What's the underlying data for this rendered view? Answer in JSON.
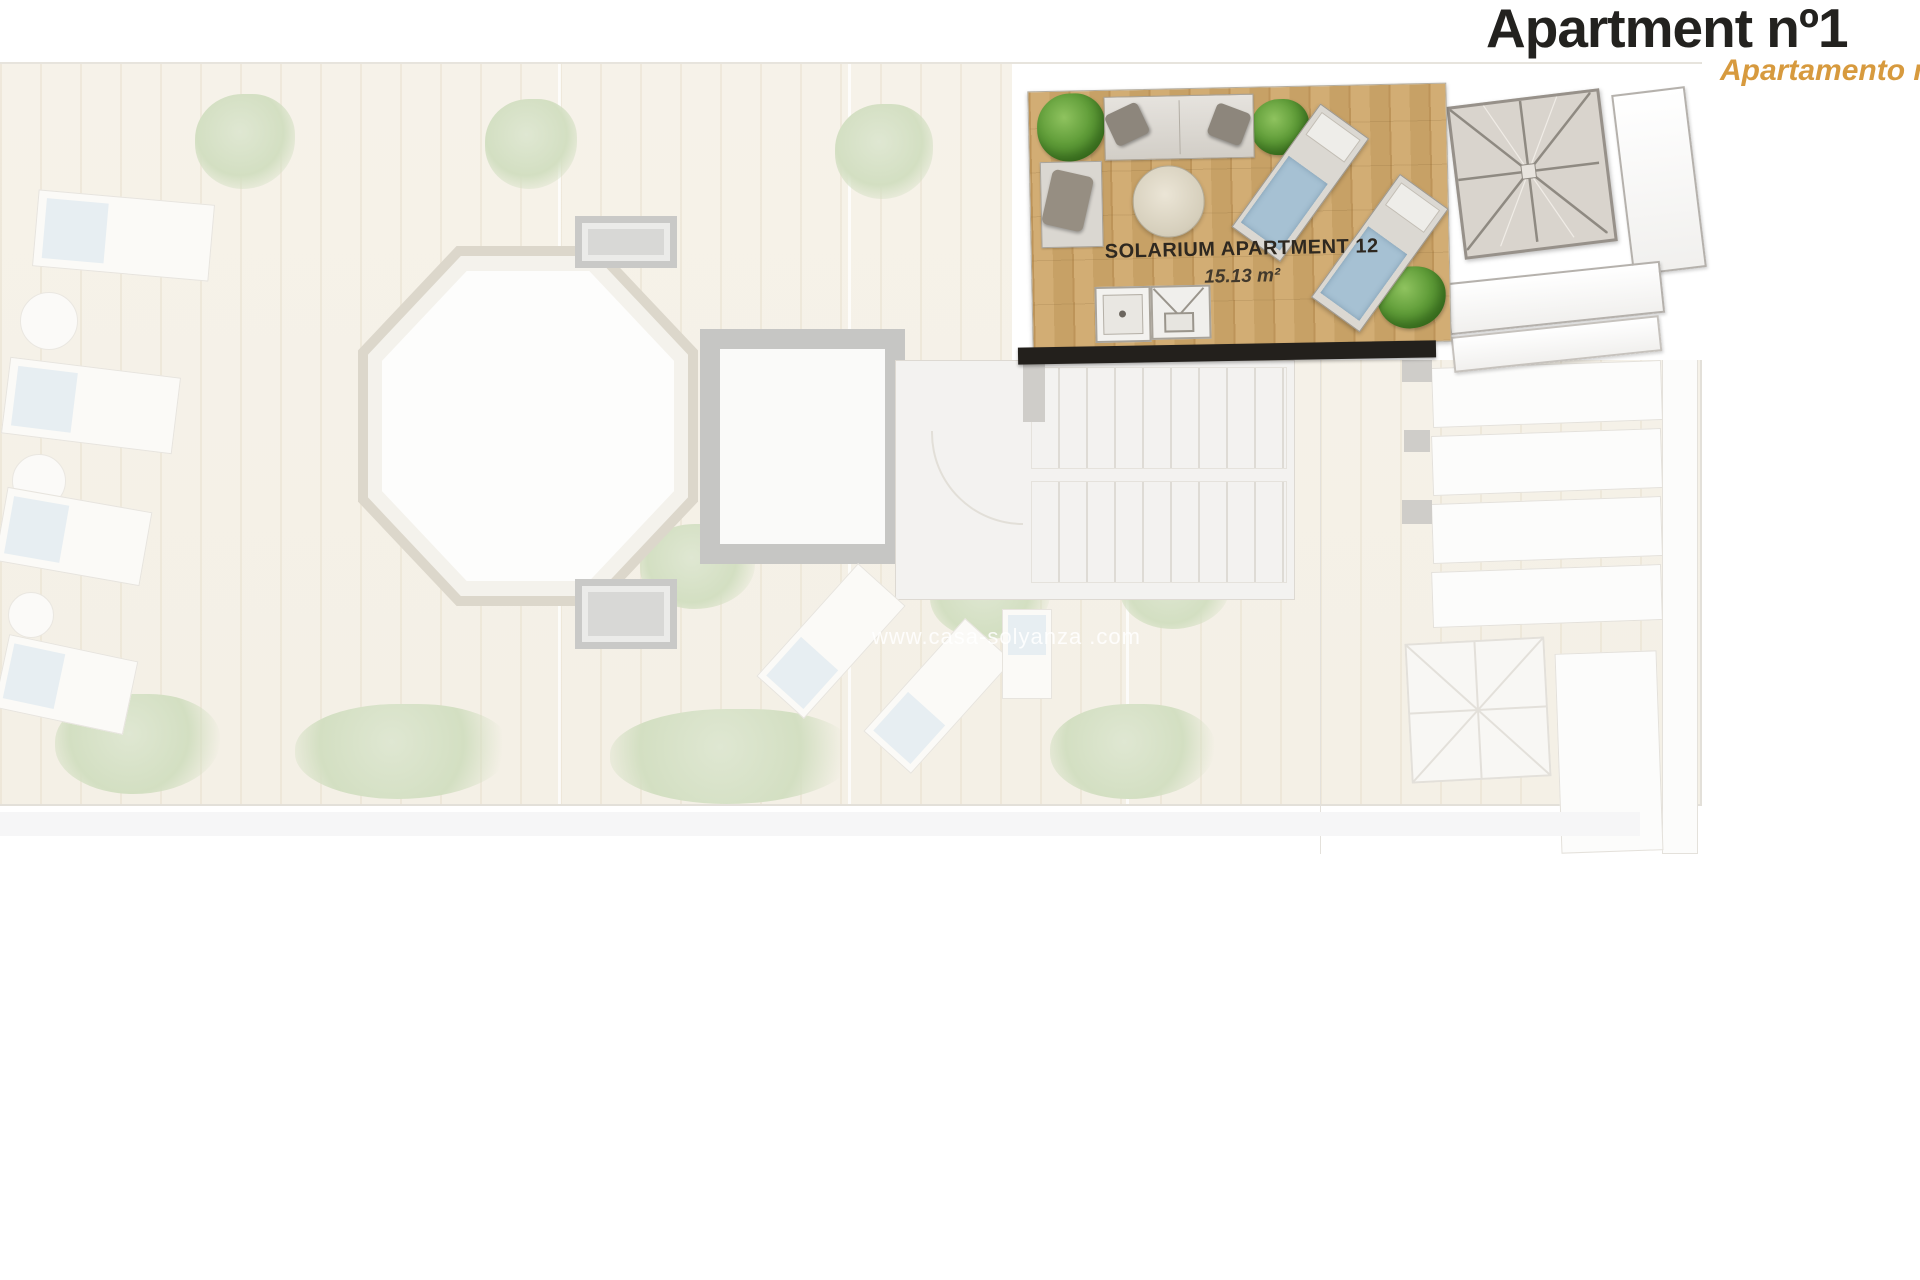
{
  "header": {
    "title": "Apartment nº1",
    "subtitle": "Apartamento nº",
    "title_color": "#23221f",
    "subtitle_color": "#d79a3e"
  },
  "solarium": {
    "label": "SOLARIUM APARTMENT 12",
    "area": "15.13 m²",
    "deck_color": "#cba76c",
    "wall_color": "#23201c",
    "towel_color": "#a6c1d3",
    "plant_color": "#5f9c38"
  },
  "plan": {
    "watermark": "www.casa-solyanza .com",
    "background_color": "#f5f1e8",
    "pool_shape": "octagon"
  },
  "icons": {
    "plant-icon": "green radial blob",
    "sofa-icon": "light rect with two dark pillows",
    "armchair-icon": "rect with rotated cushion",
    "round-table-icon": "beige circle",
    "sun-lounger-icon": "rect with blue towel",
    "shower-tray-icon": "square with drain dot",
    "storage-box-icon": "square with V fold lines",
    "hip-roof-icon": "square with radiating ridge lines",
    "pool-icon": "white octagon",
    "stairs-icon": "striped treads",
    "planter-icon": "nested gray rectangles"
  }
}
